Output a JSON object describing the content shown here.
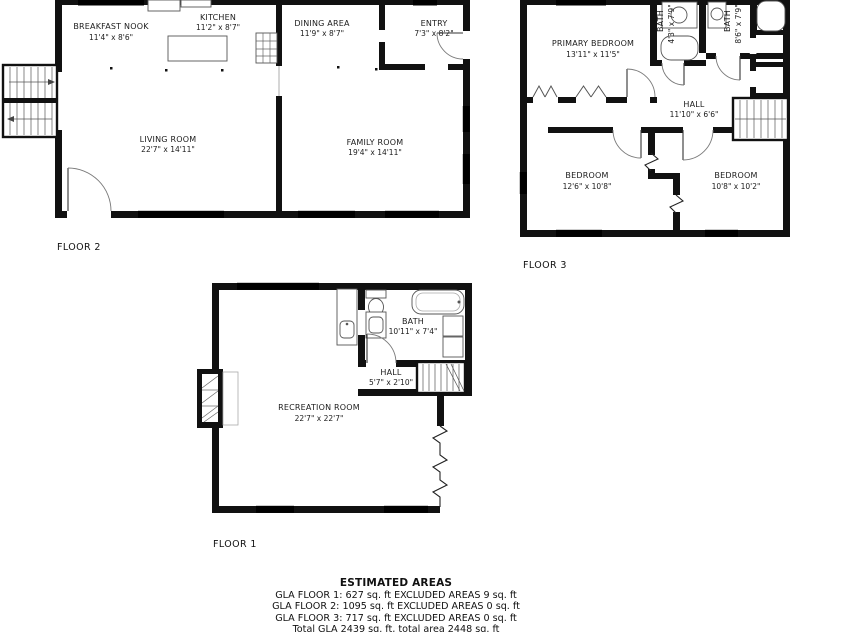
{
  "colors": {
    "walls": "#111111",
    "background": "#ffffff"
  },
  "floor2": {
    "label": "FLOOR 2",
    "rooms": [
      {
        "name": "BREAKFAST NOOK",
        "dims": "11'4\" x 8'6\""
      },
      {
        "name": "KITCHEN",
        "dims": "11'2\" x 8'7\""
      },
      {
        "name": "DINING AREA",
        "dims": "11'9\" x 8'7\""
      },
      {
        "name": "ENTRY",
        "dims": "7'3\" x 8'2\""
      },
      {
        "name": "LIVING ROOM",
        "dims": "22'7\" x 14'11\""
      },
      {
        "name": "FAMILY ROOM",
        "dims": "19'4\" x 14'11\""
      }
    ]
  },
  "floor3": {
    "label": "FLOOR 3",
    "rooms": [
      {
        "name": "PRIMARY BEDROOM",
        "dims": "13'11\" x 11'5\""
      },
      {
        "name": "BATH",
        "dims": "4'3\" x 7'9\""
      },
      {
        "name": "BATH",
        "dims": "8'6\" x 7'9\""
      },
      {
        "name": "HALL",
        "dims": "11'10\" x 6'6\""
      },
      {
        "name": "BEDROOM",
        "dims": "12'6\" x 10'8\""
      },
      {
        "name": "BEDROOM",
        "dims": "10'8\" x 10'2\""
      }
    ]
  },
  "floor1": {
    "label": "FLOOR 1",
    "rooms": [
      {
        "name": "BATH",
        "dims": "10'11\" x 7'4\""
      },
      {
        "name": "HALL",
        "dims": "5'7\" x 2'10\""
      },
      {
        "name": "RECREATION ROOM",
        "dims": "22'7\" x 22'7\""
      }
    ]
  },
  "summary": {
    "title": "ESTIMATED AREAS",
    "lines": [
      "GLA FLOOR 1: 627 sq. ft EXCLUDED AREAS 9 sq. ft",
      "GLA FLOOR 2: 1095 sq. ft EXCLUDED AREAS 0 sq. ft",
      "GLA FLOOR 3: 717 sq. ft EXCLUDED AREAS 0 sq. ft",
      "Total GLA 2439 sq. ft, total area 2448 sq. ft"
    ]
  }
}
